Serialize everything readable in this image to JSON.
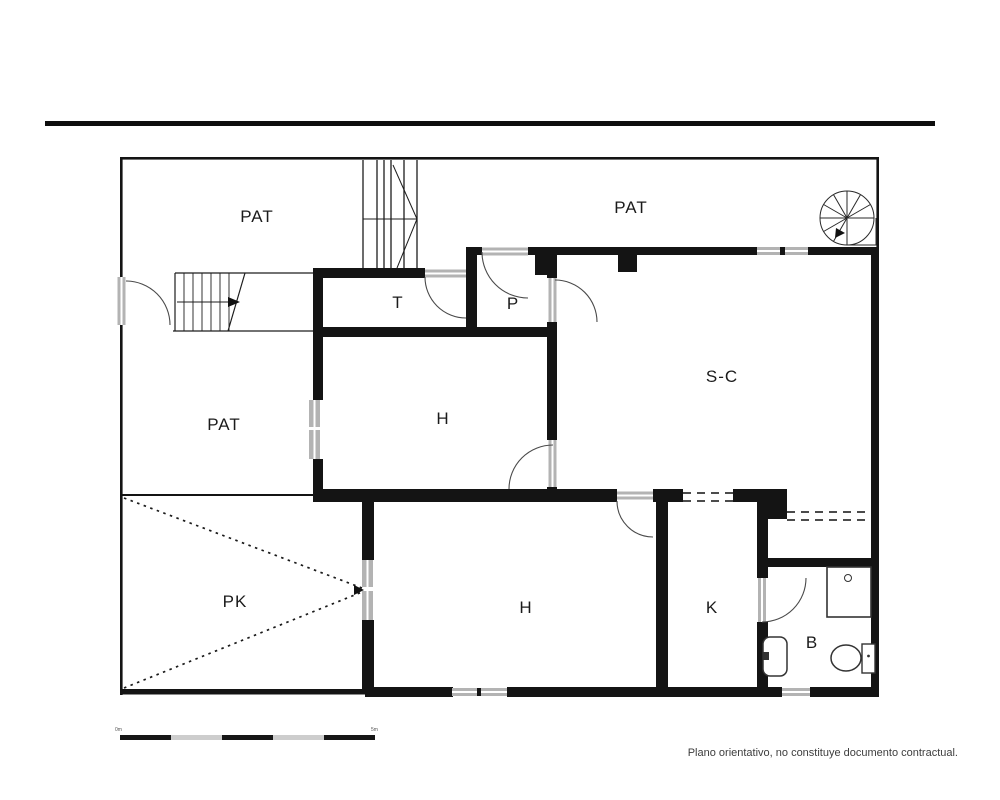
{
  "plan": {
    "type": "floor-plan",
    "rooms": [
      {
        "id": "patio-top-left",
        "label": "PAT"
      },
      {
        "id": "patio-top-right",
        "label": "PAT"
      },
      {
        "id": "patio-left",
        "label": "PAT"
      },
      {
        "id": "storage",
        "label": "T"
      },
      {
        "id": "porch",
        "label": "P"
      },
      {
        "id": "living-dining",
        "label": "S-C"
      },
      {
        "id": "hall-middle",
        "label": "H"
      },
      {
        "id": "hall-bottom",
        "label": "H"
      },
      {
        "id": "parking",
        "label": "PK"
      },
      {
        "id": "kitchen",
        "label": "K"
      },
      {
        "id": "bathroom",
        "label": "B"
      }
    ],
    "colors": {
      "walls": "#141414",
      "windows": "#b3b3b3",
      "door_arcs": "#4a4a4a",
      "background": "#ffffff"
    }
  },
  "scale_bar": {
    "segments": 5,
    "left_label": "0m",
    "right_label": "5m"
  },
  "footer": {
    "disclaimer": "Plano orientativo, no constituye documento contractual."
  }
}
